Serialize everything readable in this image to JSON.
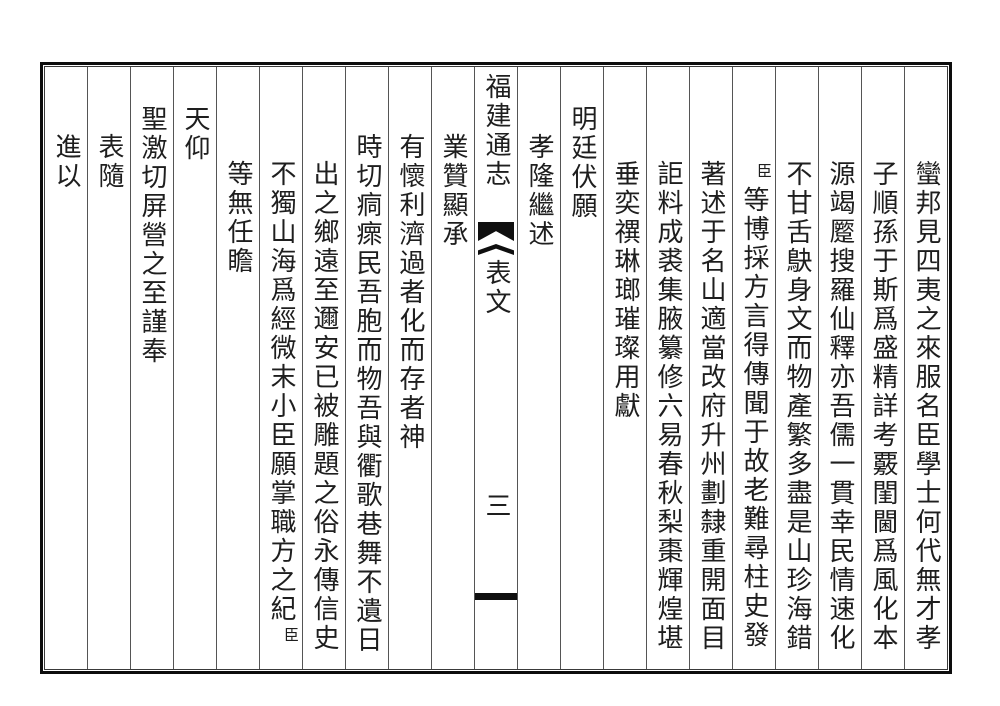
{
  "page": {
    "kind": "classical-chinese-block-print-page",
    "book_title": "福建通志",
    "section_title": "表文",
    "page_number": "三",
    "ink_color": "#1e1e1e",
    "border_color": "#0d0d0d",
    "background_color": "#ffffff",
    "reading_order": "columns right-to-left, characters top-to-bottom"
  },
  "columns": [
    {
      "text": "蠻邦見四夷之來服名臣學士何代無才孝",
      "raise_level": 0
    },
    {
      "text": "子順孫于斯爲盛精詳考覈閨閫爲風化本",
      "raise_level": 0
    },
    {
      "text": "源竭蹷搜羅仙釋亦吾儒一貫幸民情速化",
      "raise_level": 0
    },
    {
      "text": "不甘舌鴃身文而物產繁多盡是山珍海錯",
      "raise_level": 0
    },
    {
      "small_prefix": "臣",
      "text": "等博採方言得傳聞于故老難尋柱史發",
      "raise_level": 0
    },
    {
      "text": "著述于名山適當改府升州劃隸重開面目",
      "raise_level": 0
    },
    {
      "text": "詎料成裘集腋纂修六易春秋梨棗輝煌堪",
      "raise_level": 0
    },
    {
      "text": "垂奕禩琳瑯璀璨用獻",
      "raise_level": 0
    },
    {
      "text": "明廷伏願",
      "raise_level": 2
    },
    {
      "text": "孝隆繼述",
      "raise_level": 1
    },
    {
      "type": "banxin",
      "title": "福建通志",
      "fishtail_icon": "black double fishtail ornament",
      "section": "表文",
      "page_number": "三",
      "black_bar": true
    },
    {
      "text": "業贊顯承",
      "raise_level": 1
    },
    {
      "text": "有懷利濟過者化而存者神",
      "raise_level": 1
    },
    {
      "text": "時切痌瘝民吾胞而物吾與衢歌巷舞不遺日",
      "raise_level": 1
    },
    {
      "text": "出之鄉遠至邇安已被雕題之俗永傳信史",
      "raise_level": 0
    },
    {
      "text": "不獨山海爲經微末小臣願掌職方之紀",
      "small_suffix": "臣",
      "raise_level": 0
    },
    {
      "text": "等無任瞻",
      "raise_level": 0
    },
    {
      "text": "天仰",
      "raise_level": 2
    },
    {
      "text": "聖激切屏營之至謹奉",
      "raise_level": 2
    },
    {
      "text": "表隨",
      "raise_level": 1
    },
    {
      "text": "進以",
      "raise_level": 1
    }
  ]
}
